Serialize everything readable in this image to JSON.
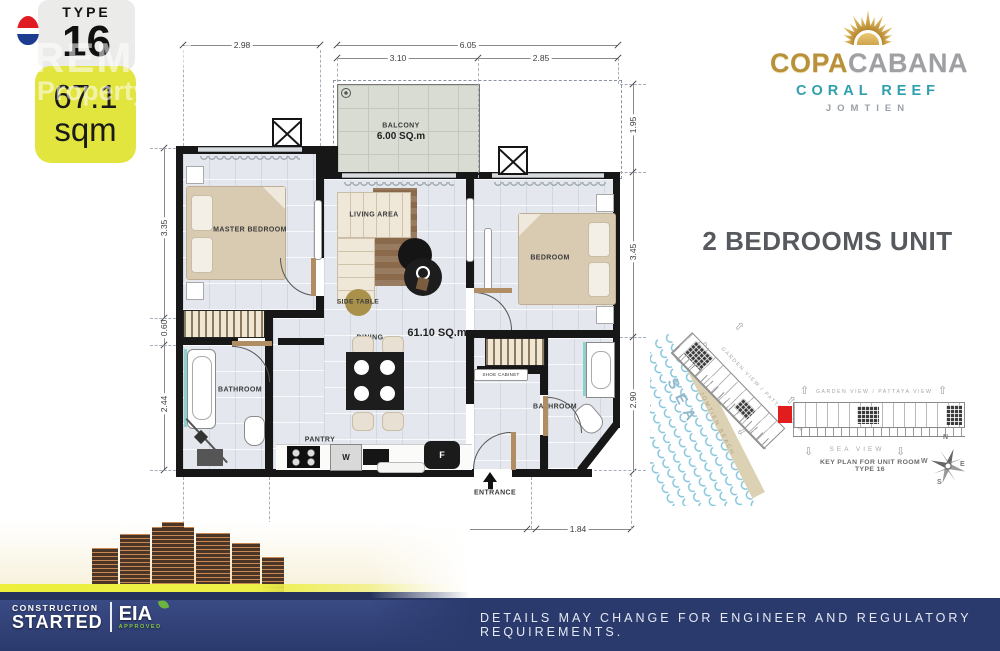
{
  "badge": {
    "type_label": "TYPE",
    "type_number": "16",
    "area_value": "67.1",
    "area_unit": "sqm"
  },
  "watermark": {
    "line1": "REMAX",
    "line2": "Property Pros"
  },
  "logo": {
    "brand_left": "COPA",
    "brand_right": "CABANA",
    "subtitle": "CORAL REEF",
    "location": "JOMTIEN"
  },
  "heading": {
    "title": "2 BEDROOMS UNIT"
  },
  "floorplan": {
    "total_area": "61.10 SQ.m",
    "balcony_name": "BALCONY",
    "balcony_area": "6.00 SQ.m",
    "master_bedroom": "MASTER BEDROOM",
    "living_area": "LIVING AREA",
    "bedroom": "BEDROOM",
    "bathroom1": "BATHROOM",
    "bathroom2": "BATHROOM",
    "dining": "DINING",
    "pantry": "PANTRY",
    "side_table": "SIDE TABLE",
    "shoe_cabinet": "SHOE CABINET",
    "entrance": "ENTRANCE",
    "washer": "W",
    "fridge": "F",
    "dims": {
      "master_width": "2.98",
      "balcony_width": "3.10",
      "terrace_width": "2.85",
      "top_total": "6.05",
      "left_top": "3.35",
      "left_mid": "0.60",
      "left_bottom": "2.44",
      "right_top": "1.95",
      "right_mid": "3.45",
      "right_bottom": "2.90",
      "bottom_left": "1.82",
      "bottom_mid": "5.46",
      "bottom_right": "1.84"
    }
  },
  "keyplan": {
    "direct_sea_view": "DIRECT SEA VIEW",
    "jomtien_beach": "JOMTIEN BEACH",
    "sea": "SEA",
    "garden_view_diagonal": "GARDEN VIEW / PATTAYA VIEW",
    "garden_view_top": "GARDEN VIEW / PATTAYA VIEW",
    "sea_view": "SEA VIEW",
    "caption": "KEY PLAN FOR UNIT ROOM TYPE 16",
    "compass": {
      "n": "N",
      "e": "E",
      "s": "S",
      "w": "W"
    },
    "arrow_glyph": "⇧"
  },
  "footer": {
    "disclaimer": "DETAILS MAY CHANGE FOR ENGINEER AND REGULATORY REQUIREMENTS.",
    "construction_top": "CONSTRUCTION",
    "construction_bottom": "STARTED",
    "eia": "EIA",
    "eia_sub": "APPROVED"
  },
  "colors": {
    "accent_yellow": "#e2e53e",
    "brand_teal": "#2f9fae",
    "brand_gold": "#b8913a",
    "navy": "#2b3a6d",
    "unit_red": "#e11d1d"
  }
}
